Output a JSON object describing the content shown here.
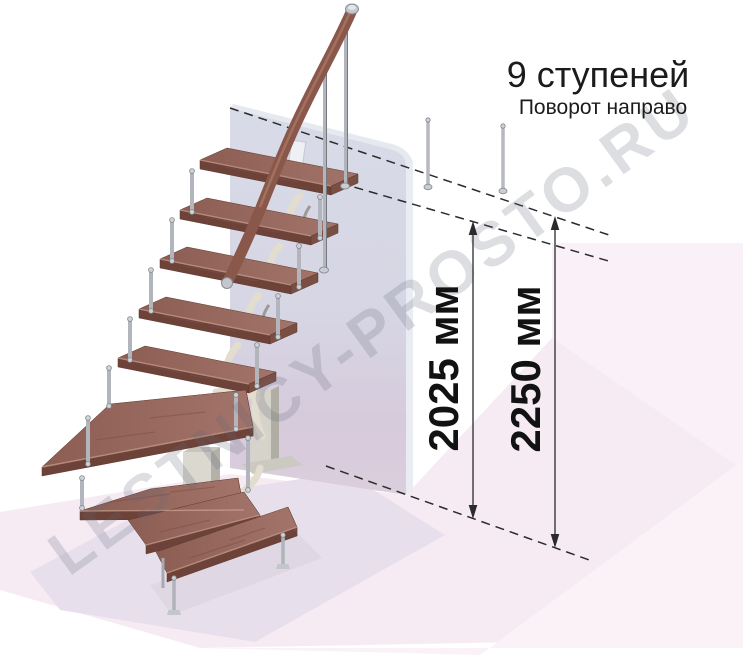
{
  "header": {
    "title": "9 ступеней",
    "subtitle": "Поворот направо"
  },
  "dimensions": [
    {
      "label": "2025 мм"
    },
    {
      "label": "2250 мм"
    }
  ],
  "watermark": {
    "text": "LESTNICY-PROSTO.RU"
  },
  "scene": {
    "steps_total": 9,
    "colors": {
      "tread_wood": "#96675b",
      "tread_front": "#6d4238",
      "handrail_wood": "#8a584a",
      "metal_post": "#b2b5bb",
      "support_ivory": "#e3ddd0",
      "wall": "#d6d7e4",
      "floor_pink": "#f6ebf3",
      "floor_shadow": "#e7e0ec",
      "dimension_line": "#2b2b2b",
      "text": "#1b1b1b",
      "watermark": "#aaadba"
    }
  }
}
